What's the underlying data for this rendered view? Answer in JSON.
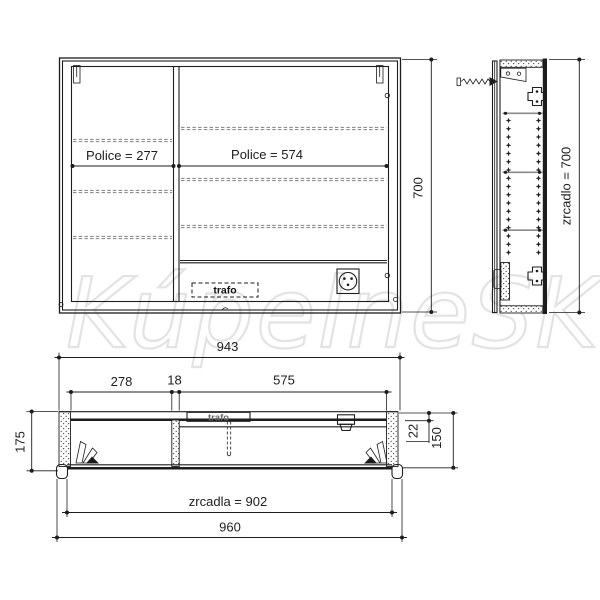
{
  "watermark": {
    "text": "KúpelneSK"
  },
  "views": {
    "front": {
      "police_left": "Police = 277",
      "police_right": "Police = 574",
      "height": "700",
      "trafo": "trafo"
    },
    "side": {
      "mirror_height": "zrcadlo = 700"
    },
    "plan": {
      "carcass_width": "943",
      "left_width": "278",
      "divider": "18",
      "right_width": "575",
      "total_depth": "175",
      "back_rail": "22",
      "depth": "150",
      "mirror_width": "zrcadla = 902",
      "total_width": "960",
      "trafo": "trafo"
    }
  },
  "icons": {
    "socket": "power-outlet-icon",
    "screw": "wall-screw-icon",
    "hanger": "hanging-bracket-icon",
    "hinge_cross": "hinge-cross-icon",
    "shelf_pins": "shelf-pin-holes",
    "door_hinge": "door-hinge-leaves-icon"
  },
  "colors": {
    "line": "#1d1d1d",
    "shelf": "#8f8f8f",
    "watermark": "#e3e3e3",
    "trafo_gray": "#6b6b6b"
  }
}
